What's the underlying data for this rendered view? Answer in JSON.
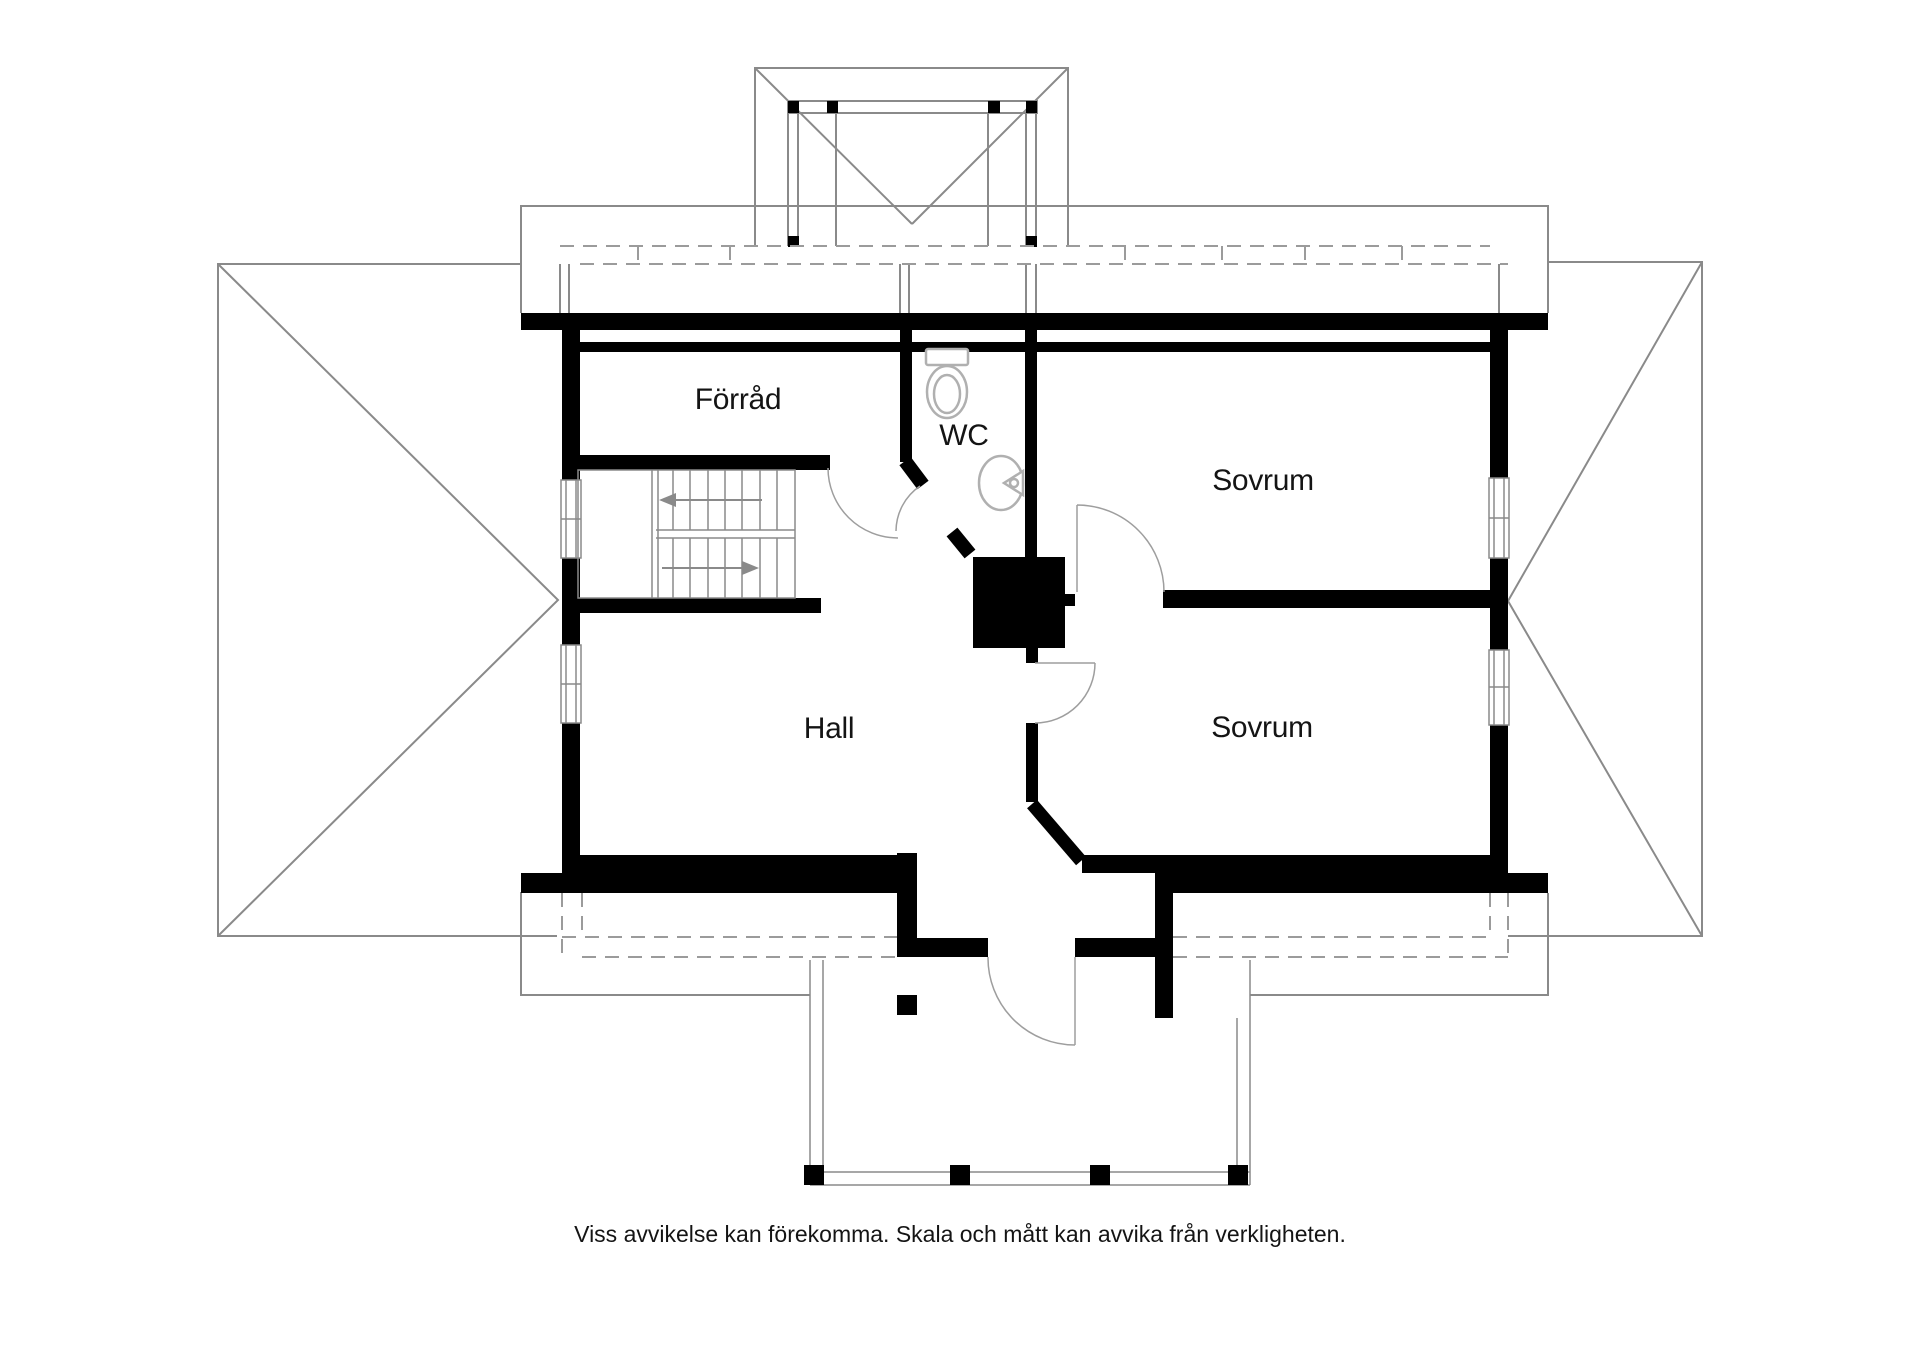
{
  "floorplan": {
    "type": "architectural-floor-plan",
    "floor": "upper floor",
    "rooms": [
      {
        "id": "forrad",
        "label": "Förråd"
      },
      {
        "id": "wc",
        "label": "WC"
      },
      {
        "id": "sovrum_upper",
        "label": "Sovrum"
      },
      {
        "id": "sovrum_lower",
        "label": "Sovrum"
      },
      {
        "id": "hall",
        "label": "Hall"
      }
    ],
    "fixtures": [
      "toilet",
      "sink",
      "stairs",
      "chimney",
      "balcony"
    ],
    "disclaimer": "Viss avvikelse kan förekomma. Skala och mått kan avvika från verkligheten.",
    "colors": {
      "walls": "#000000",
      "thin_lines": "#8a8a8a",
      "dashed_lines": "#9b9b9b",
      "fixture_lines": "#b0b0b0",
      "background": "#ffffff",
      "text": "#141414"
    }
  }
}
